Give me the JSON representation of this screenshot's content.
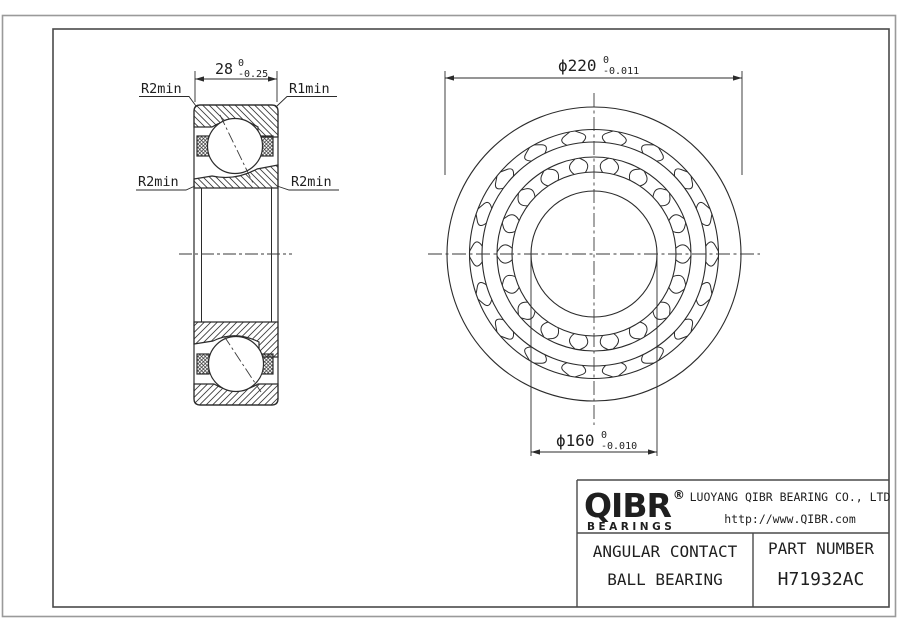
{
  "drawing": {
    "section_view": {
      "dim_width": {
        "value": "28",
        "tol_upper": "0",
        "tol_lower": "-0.25"
      },
      "label_top_left": "R2min",
      "label_top_right": "R1min",
      "label_mid_left": "R2min",
      "label_mid_right": "R2min"
    },
    "front_view": {
      "dim_outer": {
        "symbol": "ϕ",
        "value": "220",
        "tol_upper": "0",
        "tol_lower": "-0.011"
      },
      "dim_bore": {
        "symbol": "ϕ",
        "value": "160",
        "tol_upper": "0",
        "tol_lower": "-0.010"
      },
      "pocket_count": 18
    },
    "title_block": {
      "logo_wordmark": "QIBR",
      "logo_registered": "®",
      "logo_subtext": "BEARINGS",
      "company_name": "LUOYANG QIBR BEARING CO., LTD",
      "website": "http://www.QIBR.com",
      "product_type_line1": "ANGULAR CONTACT",
      "product_type_line2": "BALL BEARING",
      "part_number_label": "PART NUMBER",
      "part_number": "H71932AC"
    },
    "colors": {
      "line": "#2b2b2b",
      "centerline": "#3a3a3a",
      "frame_inner": "#4a4a4a",
      "frame_outer": "#9a9a9a",
      "text": "#1f1f1f"
    }
  }
}
